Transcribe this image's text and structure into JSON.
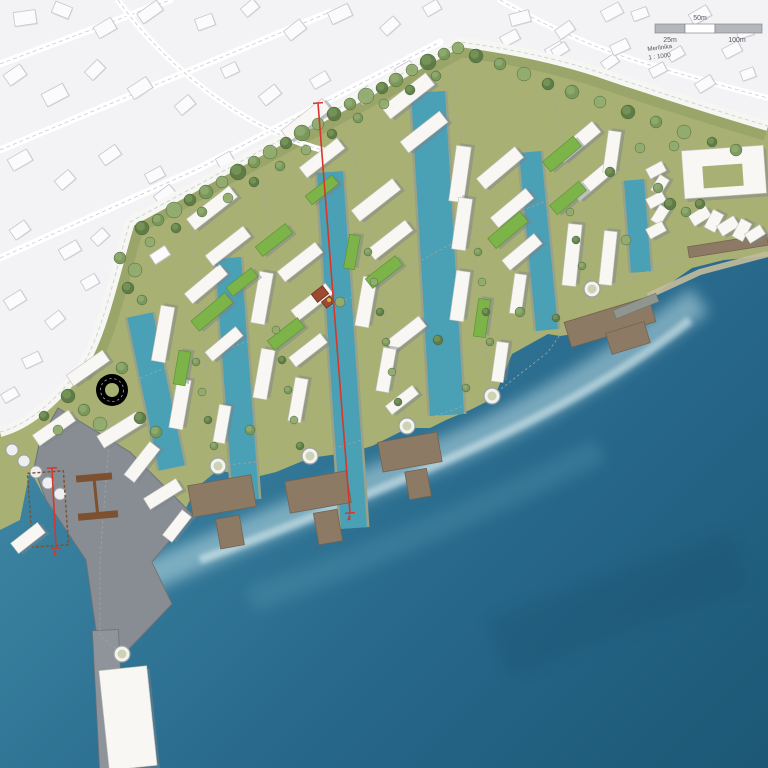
{
  "scalebar": {
    "label_mid": "50m",
    "label_left": "25m",
    "label_right": "100m",
    "scale_name": "Merilnika",
    "scale_ratio": "1 : 1000"
  },
  "palette": {
    "sea_deep": "#1c5876",
    "sea_mid": "#2e7191",
    "sea_light": "#63aec0",
    "foam": "#d8f2f4",
    "channel": "#4aa0b4",
    "land": "#a9b074",
    "land_dark": "#8c9a5e",
    "land_light": "#bcc28c",
    "road": "#ececе8",
    "road_line": "#a2a5a2",
    "existing_bg": "#f3f3f5",
    "existing_bld": "#fbfbfd",
    "existing_stroke": "#c6c6cc",
    "white_bld": "#f8f7f3",
    "bld_shadow": "#7d838b",
    "green_roof": "#7cb44a",
    "tree_dark": "#5c7a45",
    "tree_mid": "#79975a",
    "tree_light": "#92ac70",
    "pier": "#8d7a64",
    "pier_dark": "#74634f",
    "port_gray": "#878d93",
    "crane": "#7d5030",
    "section_red": "#d8362a",
    "scale_gray": "#b4b7bb"
  },
  "features": {
    "channels": [
      [
        140,
        315,
        172,
        468,
        26
      ],
      [
        228,
        258,
        246,
        500,
        26
      ],
      [
        330,
        172,
        354,
        528,
        26
      ],
      [
        428,
        92,
        447,
        415,
        34
      ],
      [
        530,
        152,
        547,
        330,
        22
      ],
      [
        634,
        180,
        641,
        272,
        20
      ]
    ],
    "white_buildings": [
      [
        163,
        334,
        56,
        14,
        -80
      ],
      [
        180,
        404,
        50,
        14,
        -80
      ],
      [
        206,
        284,
        46,
        13,
        -40
      ],
      [
        224,
        344,
        40,
        12,
        -40
      ],
      [
        222,
        424,
        38,
        12,
        -80
      ],
      [
        212,
        208,
        54,
        14,
        -38
      ],
      [
        228,
        246,
        48,
        13,
        -38
      ],
      [
        262,
        298,
        52,
        14,
        -80
      ],
      [
        300,
        262,
        48,
        13,
        -38
      ],
      [
        312,
        302,
        44,
        13,
        -38
      ],
      [
        264,
        374,
        50,
        14,
        -80
      ],
      [
        298,
        400,
        44,
        13,
        -80
      ],
      [
        308,
        350,
        40,
        12,
        -38
      ],
      [
        306,
        120,
        52,
        14,
        -38
      ],
      [
        322,
        158,
        48,
        13,
        -38
      ],
      [
        376,
        200,
        52,
        14,
        -38
      ],
      [
        390,
        240,
        48,
        13,
        -38
      ],
      [
        366,
        302,
        50,
        14,
        -80
      ],
      [
        406,
        334,
        42,
        13,
        -38
      ],
      [
        386,
        370,
        44,
        13,
        -80
      ],
      [
        402,
        400,
        34,
        11,
        -38
      ],
      [
        408,
        96,
        56,
        15,
        -38
      ],
      [
        424,
        132,
        50,
        14,
        -38
      ],
      [
        460,
        174,
        56,
        15,
        -82
      ],
      [
        462,
        224,
        52,
        14,
        -82
      ],
      [
        460,
        296,
        50,
        14,
        -82
      ],
      [
        500,
        168,
        50,
        14,
        -40
      ],
      [
        512,
        208,
        46,
        13,
        -40
      ],
      [
        522,
        252,
        42,
        13,
        -40
      ],
      [
        518,
        294,
        40,
        12,
        -82
      ],
      [
        500,
        362,
        40,
        12,
        -82
      ],
      [
        578,
        142,
        48,
        14,
        -40
      ],
      [
        592,
        182,
        44,
        13,
        -40
      ],
      [
        612,
        152,
        42,
        13,
        -82
      ],
      [
        572,
        255,
        62,
        14,
        -84
      ],
      [
        608,
        258,
        54,
        13,
        -84
      ],
      [
        724,
        172,
        82,
        48,
        -4
      ],
      [
        656,
        170,
        18,
        11,
        -28
      ],
      [
        660,
        185,
        18,
        11,
        -58
      ],
      [
        656,
        200,
        18,
        11,
        -28
      ],
      [
        660,
        215,
        18,
        11,
        -58
      ],
      [
        656,
        230,
        18,
        11,
        -28
      ],
      [
        700,
        216,
        20,
        12,
        -32
      ],
      [
        714,
        221,
        20,
        12,
        -62
      ],
      [
        728,
        226,
        20,
        12,
        -32
      ],
      [
        742,
        230,
        20,
        12,
        -62
      ],
      [
        755,
        234,
        18,
        11,
        -32
      ],
      [
        88,
        368,
        44,
        13,
        -35
      ],
      [
        54,
        428,
        44,
        13,
        -35
      ],
      [
        120,
        430,
        46,
        14,
        -32
      ],
      [
        142,
        462,
        42,
        13,
        -52
      ],
      [
        163,
        494,
        38,
        13,
        -32
      ],
      [
        177,
        526,
        32,
        12,
        -52
      ],
      [
        28,
        538,
        34,
        13,
        -38
      ],
      [
        128,
        718,
        48,
        100,
        -6
      ]
    ],
    "green_buildings": [
      [
        212,
        312,
        44,
        13,
        -40
      ],
      [
        182,
        368,
        34,
        12,
        -80
      ],
      [
        286,
        334,
        38,
        12,
        -38
      ],
      [
        274,
        240,
        38,
        12,
        -38
      ],
      [
        384,
        272,
        38,
        12,
        -38
      ],
      [
        352,
        252,
        34,
        11,
        -80
      ],
      [
        508,
        230,
        42,
        13,
        -40
      ],
      [
        482,
        318,
        38,
        12,
        -82
      ],
      [
        562,
        154,
        40,
        13,
        -40
      ],
      [
        568,
        198,
        38,
        12,
        -40
      ],
      [
        322,
        190,
        34,
        11,
        -38
      ],
      [
        242,
        282,
        32,
        11,
        -38
      ]
    ],
    "courtyards": [
      [
        723,
        176,
        40,
        22,
        -4
      ]
    ],
    "existing_buildings": [
      [
        25,
        18,
        22,
        14,
        -8
      ],
      [
        62,
        10,
        18,
        12,
        22
      ],
      [
        105,
        28,
        20,
        13,
        -30
      ],
      [
        150,
        12,
        24,
        12,
        -35
      ],
      [
        205,
        22,
        18,
        12,
        -20
      ],
      [
        250,
        8,
        16,
        11,
        -40
      ],
      [
        295,
        30,
        20,
        12,
        -38
      ],
      [
        340,
        14,
        22,
        13,
        -25
      ],
      [
        390,
        26,
        18,
        11,
        -42
      ],
      [
        432,
        8,
        16,
        11,
        -30
      ],
      [
        520,
        18,
        20,
        12,
        -15
      ],
      [
        565,
        30,
        18,
        11,
        -35
      ],
      [
        612,
        12,
        20,
        12,
        -28
      ],
      [
        640,
        14,
        16,
        10,
        -20
      ],
      [
        700,
        15,
        20,
        12,
        -30
      ],
      [
        745,
        32,
        16,
        10,
        -18
      ],
      [
        15,
        75,
        20,
        13,
        -35
      ],
      [
        55,
        95,
        24,
        14,
        -28
      ],
      [
        95,
        70,
        18,
        12,
        -45
      ],
      [
        140,
        88,
        22,
        13,
        -33
      ],
      [
        185,
        105,
        18,
        12,
        -40
      ],
      [
        230,
        70,
        16,
        11,
        -25
      ],
      [
        270,
        95,
        20,
        12,
        -38
      ],
      [
        320,
        80,
        18,
        11,
        -30
      ],
      [
        365,
        95,
        16,
        11,
        -42
      ],
      [
        405,
        70,
        18,
        12,
        -30
      ],
      [
        555,
        50,
        18,
        11,
        -30
      ],
      [
        610,
        62,
        16,
        10,
        -35
      ],
      [
        658,
        70,
        16,
        10,
        -28
      ],
      [
        705,
        84,
        18,
        11,
        -32
      ],
      [
        748,
        74,
        14,
        10,
        -20
      ],
      [
        20,
        160,
        22,
        13,
        -30
      ],
      [
        65,
        180,
        18,
        12,
        -40
      ],
      [
        110,
        155,
        20,
        12,
        -35
      ],
      [
        155,
        175,
        18,
        11,
        -28
      ],
      [
        165,
        195,
        20,
        12,
        -38
      ],
      [
        225,
        160,
        16,
        11,
        -30
      ],
      [
        20,
        230,
        18,
        12,
        -35
      ],
      [
        70,
        250,
        20,
        12,
        -30
      ],
      [
        100,
        237,
        16,
        11,
        -42
      ],
      [
        160,
        255,
        18,
        11,
        -33
      ],
      [
        15,
        300,
        20,
        12,
        -32
      ],
      [
        55,
        320,
        18,
        11,
        -38
      ],
      [
        90,
        282,
        16,
        11,
        -30
      ],
      [
        32,
        360,
        18,
        11,
        -25
      ],
      [
        10,
        395,
        16,
        10,
        -30
      ],
      [
        510,
        38,
        18,
        11,
        -28
      ],
      [
        560,
        50,
        16,
        10,
        -32
      ],
      [
        620,
        47,
        18,
        11,
        -25
      ],
      [
        676,
        54,
        16,
        10,
        -30
      ],
      [
        732,
        50,
        18,
        11,
        -28
      ]
    ],
    "trees": [
      [
        142,
        228,
        7,
        0
      ],
      [
        158,
        220,
        6,
        1
      ],
      [
        174,
        210,
        8,
        2
      ],
      [
        190,
        200,
        6,
        0
      ],
      [
        206,
        192,
        7,
        1
      ],
      [
        222,
        182,
        6,
        2
      ],
      [
        238,
        172,
        8,
        0
      ],
      [
        254,
        162,
        6,
        1
      ],
      [
        270,
        152,
        7,
        2
      ],
      [
        286,
        143,
        6,
        0
      ],
      [
        302,
        133,
        8,
        1
      ],
      [
        318,
        124,
        6,
        2
      ],
      [
        334,
        114,
        7,
        0
      ],
      [
        350,
        104,
        6,
        1
      ],
      [
        366,
        96,
        8,
        2
      ],
      [
        382,
        88,
        6,
        0
      ],
      [
        396,
        80,
        7,
        1
      ],
      [
        412,
        70,
        6,
        2
      ],
      [
        428,
        62,
        8,
        0
      ],
      [
        444,
        54,
        6,
        1
      ],
      [
        458,
        48,
        6,
        2
      ],
      [
        150,
        242,
        5,
        2
      ],
      [
        176,
        228,
        5,
        0
      ],
      [
        202,
        212,
        5,
        1
      ],
      [
        228,
        198,
        5,
        2
      ],
      [
        254,
        182,
        5,
        0
      ],
      [
        280,
        166,
        5,
        1
      ],
      [
        306,
        150,
        5,
        2
      ],
      [
        332,
        134,
        5,
        0
      ],
      [
        358,
        118,
        5,
        1
      ],
      [
        384,
        104,
        5,
        2
      ],
      [
        410,
        90,
        5,
        0
      ],
      [
        436,
        76,
        5,
        1
      ],
      [
        476,
        56,
        7,
        0
      ],
      [
        500,
        64,
        6,
        1
      ],
      [
        524,
        74,
        7,
        2
      ],
      [
        548,
        84,
        6,
        0
      ],
      [
        572,
        92,
        7,
        1
      ],
      [
        600,
        102,
        6,
        2
      ],
      [
        628,
        112,
        7,
        0
      ],
      [
        656,
        122,
        6,
        1
      ],
      [
        684,
        132,
        7,
        2
      ],
      [
        712,
        142,
        5,
        0
      ],
      [
        736,
        150,
        6,
        1
      ],
      [
        120,
        258,
        6,
        1
      ],
      [
        135,
        270,
        7,
        2
      ],
      [
        128,
        288,
        6,
        0
      ],
      [
        142,
        300,
        5,
        1
      ],
      [
        68,
        396,
        7,
        0
      ],
      [
        84,
        410,
        6,
        1
      ],
      [
        100,
        424,
        7,
        2
      ],
      [
        140,
        418,
        6,
        0
      ],
      [
        156,
        432,
        6,
        1
      ],
      [
        58,
        430,
        5,
        2
      ],
      [
        122,
        368,
        6,
        1
      ],
      [
        44,
        416,
        5,
        0
      ],
      [
        196,
        362,
        4,
        1
      ],
      [
        202,
        392,
        4,
        2
      ],
      [
        208,
        420,
        4,
        0
      ],
      [
        214,
        446,
        4,
        1
      ],
      [
        276,
        330,
        4,
        2
      ],
      [
        282,
        360,
        4,
        0
      ],
      [
        288,
        390,
        4,
        1
      ],
      [
        294,
        420,
        4,
        2
      ],
      [
        300,
        446,
        4,
        0
      ],
      [
        368,
        252,
        4,
        1
      ],
      [
        374,
        282,
        4,
        2
      ],
      [
        380,
        312,
        4,
        0
      ],
      [
        386,
        342,
        4,
        1
      ],
      [
        392,
        372,
        4,
        2
      ],
      [
        398,
        402,
        4,
        0
      ],
      [
        478,
        252,
        4,
        1
      ],
      [
        482,
        282,
        4,
        2
      ],
      [
        486,
        312,
        4,
        0
      ],
      [
        490,
        342,
        4,
        1
      ],
      [
        570,
        212,
        4,
        2
      ],
      [
        576,
        240,
        4,
        0
      ],
      [
        582,
        266,
        4,
        1
      ],
      [
        670,
        204,
        6,
        0
      ],
      [
        686,
        212,
        5,
        1
      ],
      [
        674,
        146,
        5,
        2
      ],
      [
        700,
        204,
        5,
        0
      ],
      [
        658,
        188,
        5,
        1
      ],
      [
        640,
        148,
        5,
        2
      ],
      [
        250,
        430,
        5,
        1
      ],
      [
        340,
        302,
        5,
        2
      ],
      [
        438,
        340,
        5,
        0
      ],
      [
        520,
        312,
        5,
        1
      ],
      [
        610,
        172,
        5,
        0
      ],
      [
        626,
        240,
        5,
        2
      ],
      [
        556,
        318,
        4,
        0
      ],
      [
        466,
        388,
        4,
        1
      ]
    ],
    "piers": [
      [
        222,
        496,
        64,
        32,
        -10
      ],
      [
        230,
        532,
        24,
        30,
        -10
      ],
      [
        318,
        492,
        62,
        32,
        -10
      ],
      [
        328,
        527,
        24,
        32,
        -10
      ],
      [
        410,
        452,
        60,
        30,
        -10
      ],
      [
        418,
        484,
        22,
        28,
        -10
      ],
      [
        610,
        322,
        88,
        26,
        -17
      ],
      [
        628,
        338,
        40,
        22,
        -17
      ],
      [
        728,
        246,
        80,
        11,
        -9
      ]
    ],
    "walls": [
      [
        636,
        306,
        46,
        9,
        -22
      ]
    ],
    "nodes": [
      [
        218,
        466
      ],
      [
        310,
        456
      ],
      [
        407,
        426
      ],
      [
        492,
        396
      ],
      [
        592,
        289
      ],
      [
        122,
        654
      ]
    ],
    "silos": [
      [
        12,
        450
      ],
      [
        24,
        461
      ],
      [
        36,
        472
      ],
      [
        48,
        483
      ],
      [
        60,
        494
      ]
    ],
    "pavilion": [
      [
        320,
        294,
        14,
        10,
        -38
      ],
      [
        328,
        302,
        10,
        8,
        -38
      ]
    ],
    "section_lines": [
      {
        "x1": 318,
        "y1": 103,
        "x2": 350,
        "y2": 513
      },
      {
        "x1": 52,
        "y1": 468,
        "x2": 56,
        "y2": 548
      }
    ]
  }
}
